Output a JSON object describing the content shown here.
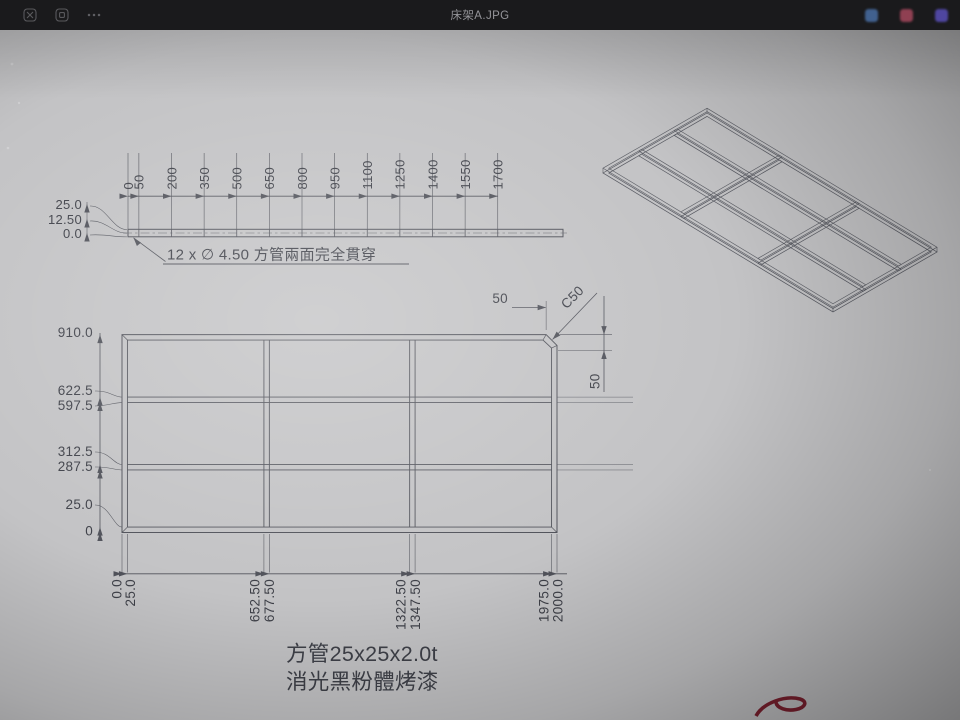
{
  "window": {
    "title": "床架A.JPG"
  },
  "titlebar_icons": {
    "left": [
      "gallery-icon",
      "slideshow-icon",
      "more-icon"
    ],
    "right": [
      {
        "name": "app-icon-blue",
        "color": "#41618f"
      },
      {
        "name": "app-icon-red",
        "color": "#8f4052"
      },
      {
        "name": "app-icon-purple",
        "color": "#4f46a0"
      }
    ]
  },
  "drawing": {
    "hole_note": "12 x ∅ 4.50 方管兩面完全貫穿",
    "material_note_line1": "方管25x25x2.0t",
    "material_note_line2": "消光黑粉體烤漆",
    "top_view": {
      "stations": [
        0,
        50,
        200,
        350,
        500,
        650,
        800,
        950,
        1100,
        1250,
        1400,
        1550,
        1700
      ],
      "height_labels": [
        "25.0",
        "12.50",
        "0.0"
      ]
    },
    "front_view": {
      "x_stations": [
        0,
        25,
        652.5,
        677.5,
        1322.5,
        1347.5,
        1975,
        2000
      ],
      "x_labels": [
        "0.0",
        "25.0",
        "652.50",
        "677.50",
        "1322.50",
        "1347.50",
        "1975.0",
        "2000.0"
      ],
      "y_stations": [
        0,
        25,
        287.5,
        312.5,
        597.5,
        622.5,
        910
      ],
      "y_labels": [
        "0",
        "25.0",
        "287.5",
        "312.5",
        "597.5",
        "622.5",
        "910.0"
      ],
      "chamfer_label": "C50",
      "chamfer_h_label": "50",
      "chamfer_v_label": "50"
    },
    "colors": {
      "line": "#50525a",
      "text": "#3e4048",
      "mark": "#7e2130"
    }
  }
}
